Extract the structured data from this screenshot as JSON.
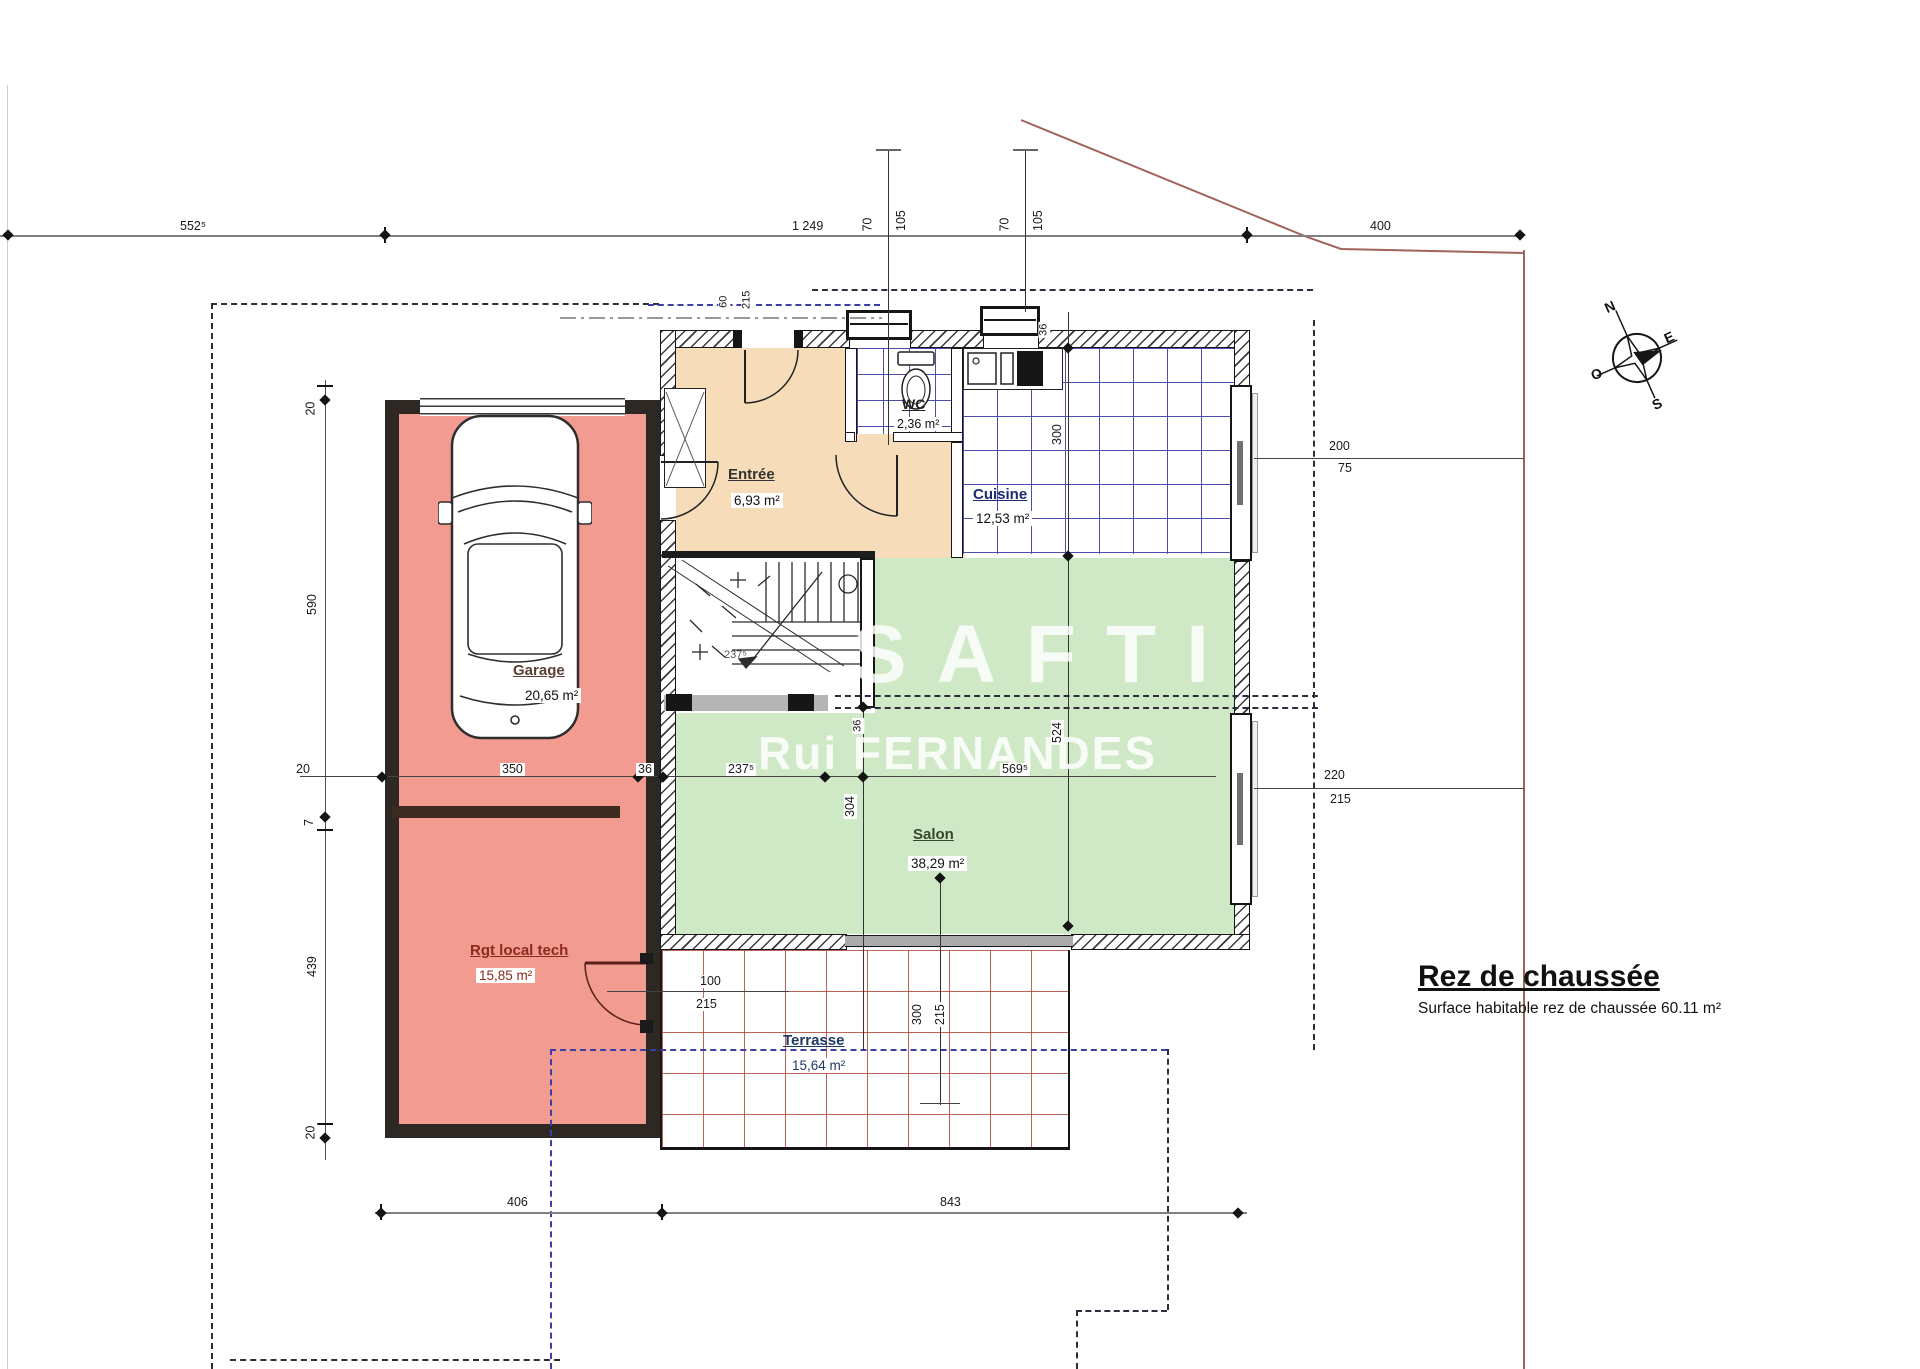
{
  "title": {
    "heading": "Rez de chaussée",
    "subtitle": "Surface habitable rez de chaussée 60.11 m²"
  },
  "watermark": {
    "brand": "SAFTI",
    "agent": "Rui FERNANDES"
  },
  "compass": {
    "north": "N",
    "east": "E",
    "south": "S",
    "west": "O"
  },
  "rooms": {
    "entree": {
      "name": "Entrée",
      "area": "6,93 m²"
    },
    "wc": {
      "name": "WC",
      "area": "2,36 m²"
    },
    "cuisine": {
      "name": "Cuisine",
      "area": "12,53 m²"
    },
    "salon": {
      "name": "Salon",
      "area": "38,29 m²"
    },
    "garage": {
      "name": "Garage",
      "area": "20,65 m²"
    },
    "local_tech": {
      "name": "Rgt local tech",
      "area": "15,85 m²"
    },
    "terrasse": {
      "name": "Terrasse",
      "area": "15,64 m²"
    }
  },
  "dimensions": {
    "top": {
      "seg1": "552⁵",
      "seg2": "1 249",
      "offset1a": "70",
      "offset1b": "105",
      "offset2a": "70",
      "offset2b": "105",
      "seg3": "400"
    },
    "left": {
      "seg1": "20",
      "seg2": "590",
      "seg3": "7",
      "seg4": "439",
      "seg5": "20"
    },
    "middle": {
      "seg1": "20",
      "seg2": "350",
      "seg3": "36",
      "seg4": "237⁵",
      "seg5": "569⁵"
    },
    "bottom": {
      "seg1": "406",
      "seg2": "843"
    },
    "right_window_kitchen": {
      "width": "200",
      "sill": "75"
    },
    "right_window_salon": {
      "width": "220",
      "sill": "215"
    },
    "kitchen_depth": "300",
    "salon_depth": "524",
    "salon_width_left": "304",
    "stair_well": "237⁵",
    "terrace_door": {
      "width": "300",
      "height": "215"
    },
    "tech_door": {
      "width": "100",
      "height": "215"
    },
    "entry_door": {
      "width": "60",
      "height": "215"
    },
    "wall_kitchen": "36",
    "wall_stair": "36"
  },
  "colors": {
    "garage_fill": "#f19b91",
    "entry_fill": "#f7dcba",
    "salon_fill": "#cfe8c5",
    "tile_blue": "#4d4daf",
    "tile_red": "#b2483c",
    "property_red": "#a2635c",
    "boundary_blue": "#3d3da6"
  }
}
